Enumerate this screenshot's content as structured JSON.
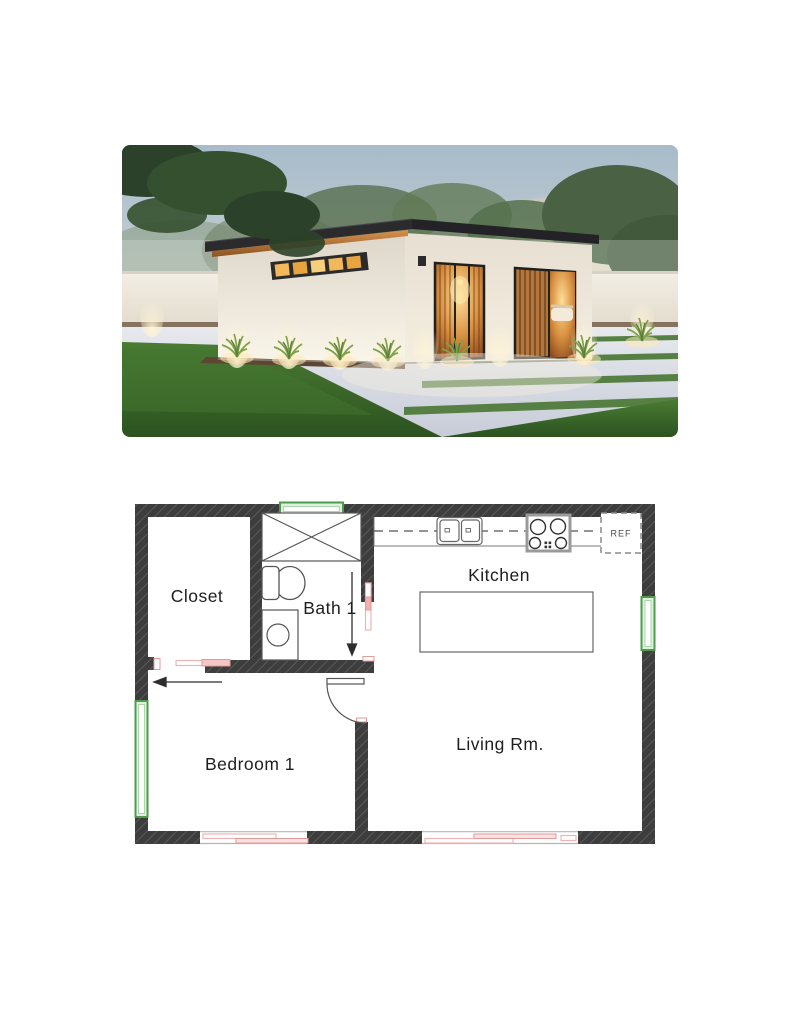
{
  "page": {
    "background": "#ffffff"
  },
  "exterior_photo": {
    "description": "modern flat-roof house exterior render at dusk with lawn, patio and perimeter wall",
    "colors": {
      "sky_top": "#a7bbca",
      "sky_horizon": "#efddc2",
      "lawn": "#3f6f2e",
      "house_wall": "#f4efe6",
      "roof": "#2b2b2e",
      "wood_accent": "#b3763c",
      "window_glow": "#f5c56a"
    }
  },
  "floor_plan": {
    "rooms": [
      {
        "name": "Closet"
      },
      {
        "name": "Bath 1"
      },
      {
        "name": "Kitchen"
      },
      {
        "name": "Bedroom 1"
      },
      {
        "name": "Living Rm."
      }
    ],
    "refrigerator_label": "REF",
    "fixtures": [
      "shower",
      "toilet",
      "washer",
      "double-sink",
      "stove",
      "refrigerator",
      "kitchen-island"
    ],
    "colors": {
      "wall": "#3d3d3d",
      "window_green": "#4c9c4c",
      "door_pink": "#e59a9a",
      "line": "#555555"
    }
  }
}
